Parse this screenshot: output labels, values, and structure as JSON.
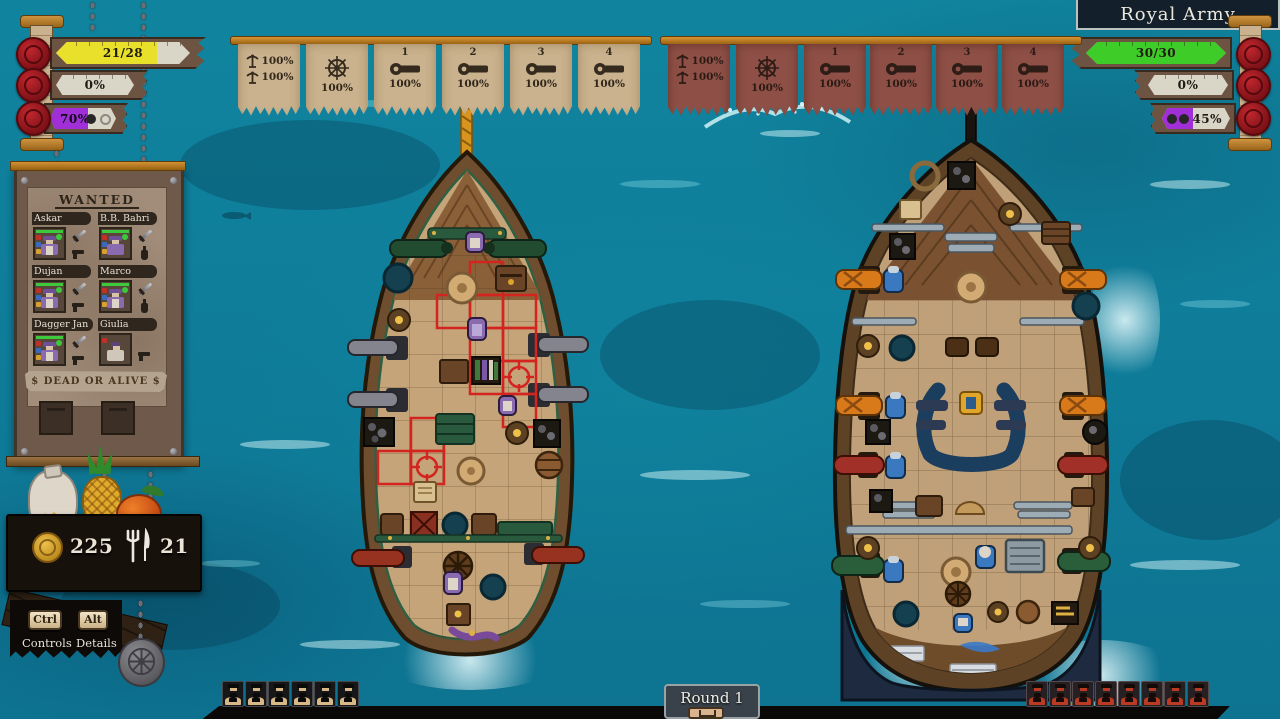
{
  "colors": {
    "hull_bar_yellow": "#e8e02a",
    "enemy_bar_green": "#3ecc28",
    "morale_purple": "#a02fd8",
    "banner_tan": "#c9b28d",
    "banner_red": "#8e5046",
    "ocean": "#0f7e9b"
  },
  "hud_left": {
    "bars": [
      {
        "id": "hull",
        "icon": "seal-hull-icon",
        "value": "21/28",
        "pct": 75
      },
      {
        "id": "sails",
        "icon": "seal-sails-icon",
        "value": "0%",
        "pct": 0
      },
      {
        "id": "morale",
        "icon": "seal-morale-icon",
        "value": "70%",
        "pct": 70
      }
    ]
  },
  "hud_right": {
    "title": "Royal Army",
    "bars": [
      {
        "id": "hull",
        "icon": "seal-hull-icon",
        "value": "30/30",
        "pct": 100
      },
      {
        "id": "sails",
        "icon": "seal-sails-icon",
        "value": "0%",
        "pct": 0
      },
      {
        "id": "morale",
        "icon": "seal-morale-icon",
        "value": "45%",
        "pct": 45
      }
    ]
  },
  "banners": {
    "left": {
      "side": "player",
      "items": [
        {
          "icon": "mast-icon",
          "rows": [
            "100%",
            "100%"
          ]
        },
        {
          "icon": "wheel-icon",
          "value": "100%"
        },
        {
          "icon": "cannon-icon",
          "label": "1",
          "value": "100%"
        },
        {
          "icon": "cannon-icon",
          "label": "2",
          "value": "100%"
        },
        {
          "icon": "cannon-icon",
          "label": "3",
          "value": "100%"
        },
        {
          "icon": "cannon-icon",
          "label": "4",
          "value": "100%"
        }
      ]
    },
    "right": {
      "side": "enemy",
      "items": [
        {
          "icon": "mast-icon",
          "rows": [
            "100%",
            "100%"
          ]
        },
        {
          "icon": "wheel-icon",
          "value": "100%"
        },
        {
          "icon": "cannon-icon",
          "label": "1",
          "value": "100%"
        },
        {
          "icon": "cannon-icon",
          "label": "2",
          "value": "100%"
        },
        {
          "icon": "cannon-icon",
          "label": "3",
          "value": "100%"
        },
        {
          "icon": "cannon-icon",
          "label": "4",
          "value": "100%"
        }
      ]
    }
  },
  "wanted": {
    "title": "WANTED",
    "bounty": "$ DEAD OR ALIVE $",
    "crew": [
      {
        "name": "Askar",
        "weapons": [
          "sword",
          "pistol"
        ]
      },
      {
        "name": "B.B. Bahri",
        "weapons": [
          "sword",
          "bottle"
        ]
      },
      {
        "name": "Dujan",
        "weapons": [
          "sword",
          "pistol"
        ]
      },
      {
        "name": "Marco",
        "weapons": [
          "sword",
          "bottle"
        ]
      },
      {
        "name": "Dagger Jan",
        "weapons": [
          "sword",
          "pistol"
        ]
      },
      {
        "name": "Giulia",
        "weapons": [
          "pistol"
        ]
      }
    ]
  },
  "resources": {
    "coins": "225",
    "food": "21"
  },
  "controls": {
    "keys": [
      {
        "key": "Ctrl",
        "label": "Controls"
      },
      {
        "key": "Alt",
        "label": "Details"
      }
    ]
  },
  "round": {
    "label": "Round 1"
  },
  "crew_counters": {
    "ally": 6,
    "enemy": 8
  }
}
